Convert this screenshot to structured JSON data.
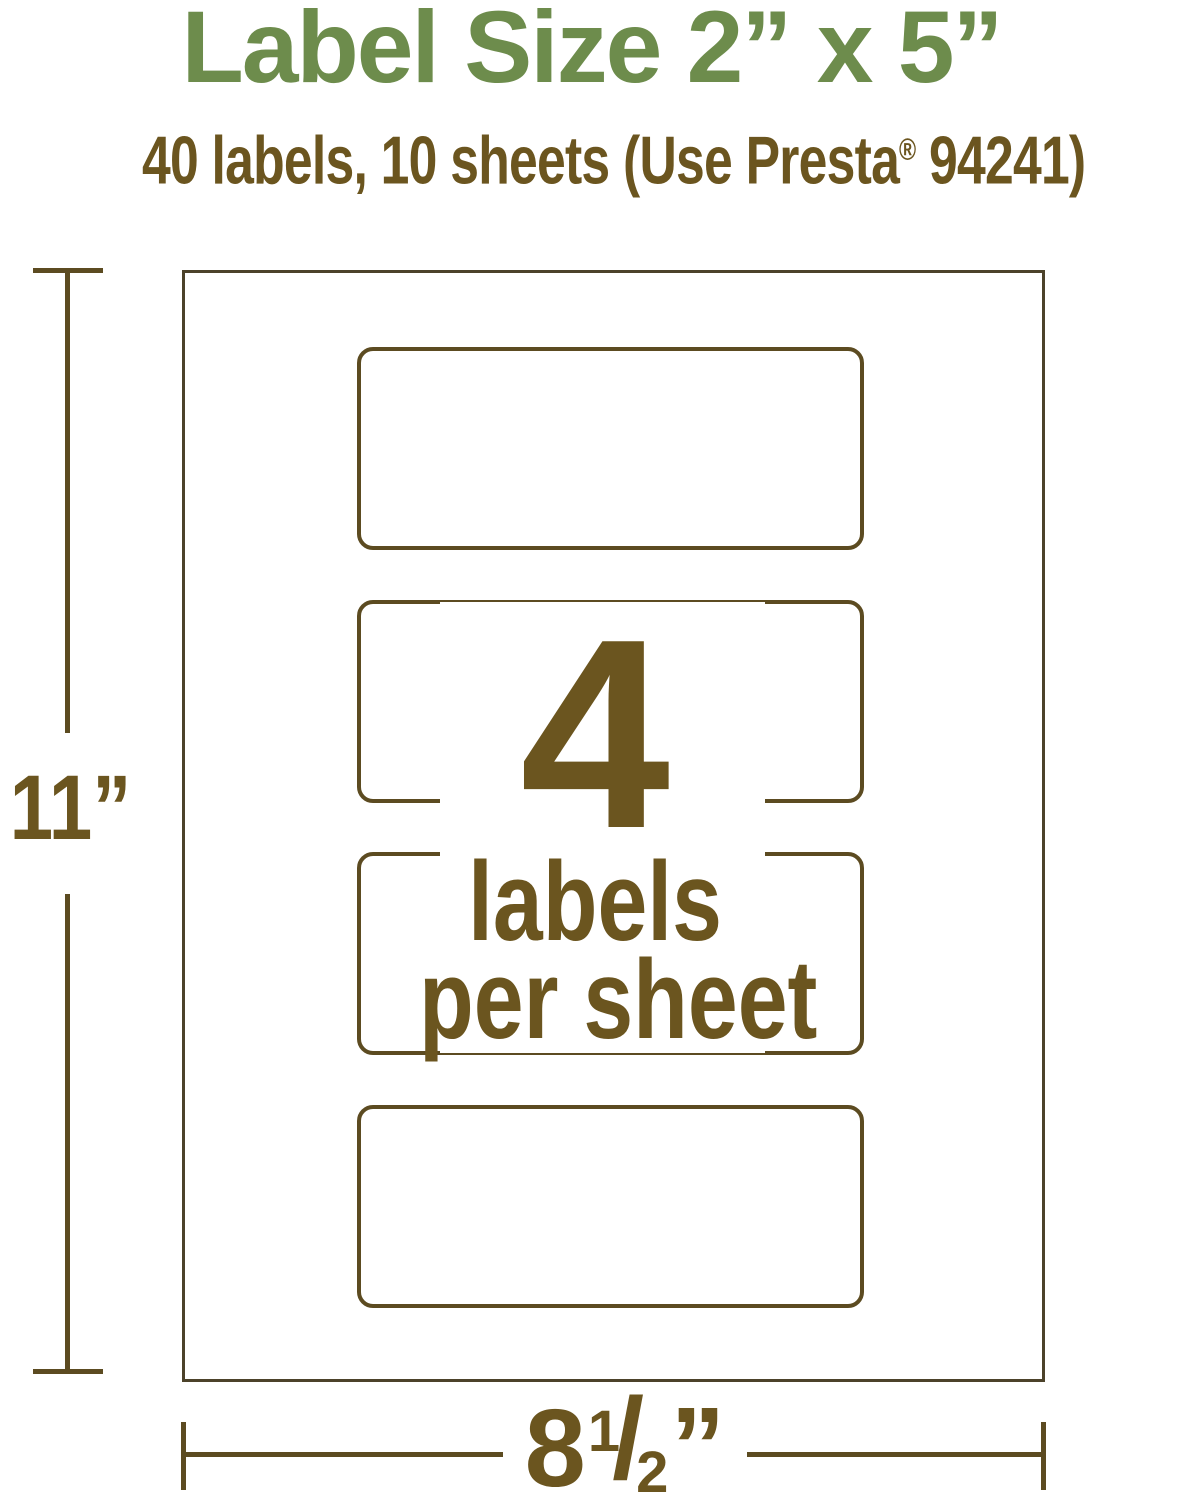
{
  "header": {
    "title": "Label Size 2” x 5”",
    "subtitle_prefix": "40 labels, 10 sheets (Use Presta",
    "subtitle_reg_mark": "®",
    "subtitle_suffix": " 94241)"
  },
  "diagram": {
    "count": "4",
    "count_caption_line1": "labels",
    "count_caption_line2": "per sheet",
    "height_label": "11”",
    "width_whole": "8",
    "width_frac_numerator": "1",
    "width_frac_slash": "/",
    "width_frac_denominator": "2",
    "width_unit_mark": "”"
  },
  "colors": {
    "title_green": "#6d8c4c",
    "text_brown": "#6b551f",
    "line_brown": "#5c4b21",
    "sheet_border": "#4c422a",
    "background": "#ffffff"
  }
}
